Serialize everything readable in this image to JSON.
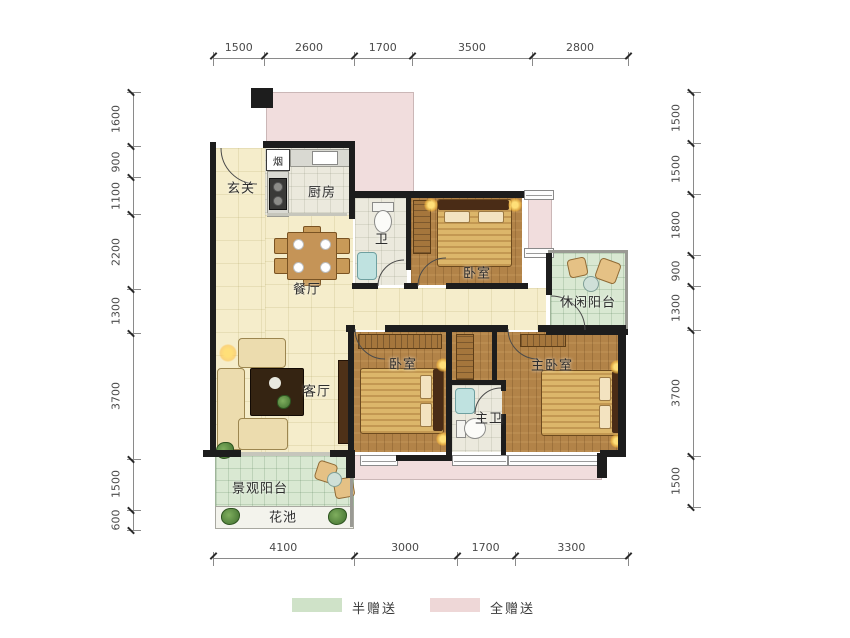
{
  "rooms": {
    "entry": {
      "label": "玄关"
    },
    "flue": {
      "label": "烟"
    },
    "kitchen": {
      "label": "厨房"
    },
    "bath": {
      "label": "卫"
    },
    "bedroom_top": {
      "label": "卧室"
    },
    "leisure_balcony": {
      "label": "休闲阳台"
    },
    "dining": {
      "label": "餐厅"
    },
    "living": {
      "label": "客厅"
    },
    "bedroom_mid": {
      "label": "卧室"
    },
    "master_bedroom": {
      "label": "主卧室"
    },
    "master_bath": {
      "label": "主卫"
    },
    "view_balcony": {
      "label": "景观阳台"
    },
    "flower_bed": {
      "label": "花池"
    }
  },
  "dimensions": {
    "top": [
      1500,
      2600,
      1700,
      3500,
      2800
    ],
    "bottom": [
      4100,
      3000,
      1700,
      3300
    ],
    "left": [
      1600,
      900,
      1100,
      2200,
      1300,
      3700,
      1500,
      600
    ],
    "right": [
      1500,
      1500,
      1800,
      900,
      1300,
      3700,
      1500
    ]
  },
  "legend": {
    "half_gift": {
      "label": "半赠送",
      "color": "#cfe2c8"
    },
    "full_gift": {
      "label": "全赠送",
      "color": "#eed7d7"
    }
  },
  "colors": {
    "wall": "#1d1d1d",
    "full_gift_zone": "#f1dddd",
    "half_gift_zone": "#d9e8d2",
    "living_floor": "#f5edcb",
    "bedroom_floor": "#b28348"
  }
}
